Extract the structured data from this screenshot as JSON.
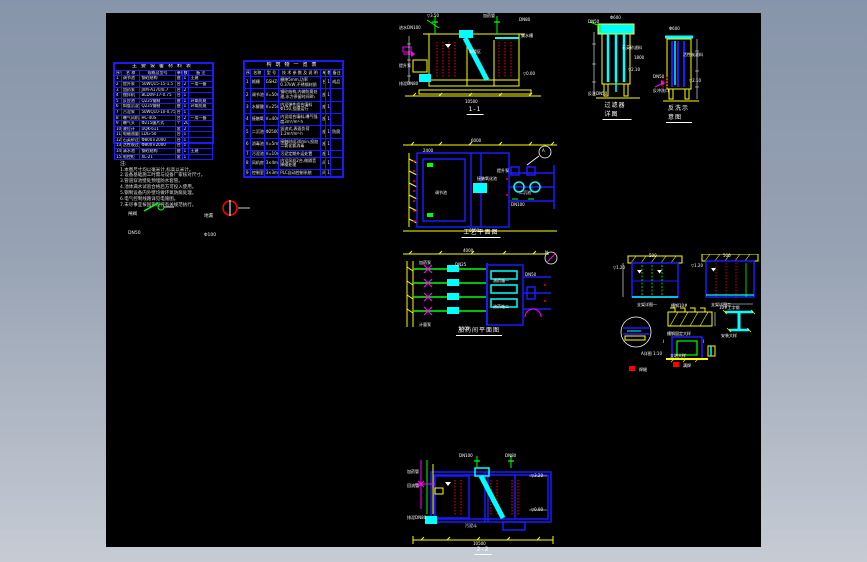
{
  "app": {
    "background_top": "#8795aa",
    "background_bottom": "#c6cbd4",
    "canvas_color": "#000000"
  },
  "colors": {
    "line_blue": "#1a1aff",
    "line_yellow": "#ffff00",
    "line_cyan": "#00ffff",
    "line_green": "#00ff00",
    "line_red": "#ff0000",
    "line_magenta": "#ff00ff",
    "text_white": "#ffffff"
  },
  "table1": {
    "title": "主要设备材料表",
    "headers": [
      "序号",
      "名 称",
      "规格及型号",
      "单位",
      "数量",
      "备 注"
    ],
    "rows": [
      [
        "1",
        "调节池",
        "钢砼结构",
        "座",
        "1",
        "土建"
      ],
      [
        "2",
        "提升泵",
        "50WQ15-15-1.5",
        "台",
        "2",
        "一用一备"
      ],
      [
        "3",
        "加药泵",
        "JXM-A170/0.7",
        "台",
        "2",
        ""
      ],
      [
        "4",
        "搅拌机",
        "BLD09-17-0.75",
        "台",
        "1",
        ""
      ],
      [
        "5",
        "反应池",
        "Q235钢制",
        "座",
        "1",
        "环氧防腐"
      ],
      [
        "6",
        "斜管沉淀池",
        "Q235钢制",
        "座",
        "1",
        "环氧防腐"
      ],
      [
        "7",
        "污泥泵",
        "50WQ10-10-0.75",
        "台",
        "1",
        ""
      ],
      [
        "8",
        "曝气风机",
        "HC-40S",
        "台",
        "2",
        "一用一备"
      ],
      [
        "9",
        "曝气头",
        "Φ215膜片式",
        "个",
        "20",
        ""
      ],
      [
        "10",
        "液位计",
        "UQK-611",
        "套",
        "2",
        ""
      ],
      [
        "11",
        "电磁流量计",
        "LDG-50",
        "台",
        "1",
        ""
      ],
      [
        "12",
        "石英砂过滤器",
        "Φ800×2000",
        "台",
        "1",
        ""
      ],
      [
        "13",
        "活性炭过滤器",
        "Φ800×2000",
        "台",
        "1",
        ""
      ],
      [
        "14",
        "清水池",
        "钢砼结构",
        "座",
        "1",
        "土建"
      ],
      [
        "15",
        "电控柜",
        "XL-21",
        "套",
        "1",
        ""
      ]
    ]
  },
  "table2": {
    "title": "构筑物一览表",
    "headers": [
      "序号",
      "名称",
      "型 号",
      "技 术 参 数 及 说 明",
      "单位",
      "数量",
      "备注"
    ],
    "rows": [
      [
        "1",
        "格栅",
        "GSHZ-500",
        "栅隙5mm,功率0.37kW,不锈钢材质",
        "台",
        "1",
        "成品"
      ],
      [
        "2",
        "调节池",
        "V=50m³",
        "钢砼结构,内做防腐处理,水力停留时间8h",
        "座",
        "1",
        ""
      ],
      [
        "3",
        "水解酸化池",
        "V=25m³",
        "内设弹性组合填料Φ150,挂膜运行",
        "座",
        "1",
        ""
      ],
      [
        "4",
        "接触氧化池",
        "V=40m³",
        "内设组合填料,曝气强度3m³/m²·h",
        "座",
        "1",
        ""
      ],
      [
        "5",
        "二沉池",
        "Φ2500",
        "竖流式,表面负荷1.2m³/m²·h",
        "座",
        "1",
        "防腐"
      ],
      [
        "6",
        "消毒池",
        "V=5m³",
        "接触时间30min,投加二氧化氯消毒",
        "座",
        "1",
        ""
      ],
      [
        "7",
        "污泥池",
        "V=10m³",
        "污泥定期外运处置",
        "座",
        "1",
        ""
      ],
      [
        "8",
        "风机房",
        "3×4m",
        "内设风机2台,做隔音降噪处理",
        "间",
        "1",
        ""
      ],
      [
        "9",
        "控制室",
        "3×3m",
        "PLC自动控制系统",
        "间",
        "1",
        ""
      ]
    ]
  },
  "notes": {
    "title": "注:",
    "lines": [
      "1.本图尺寸均以毫米计,标高以米计。",
      "2.设备基础施工时需与设备厂家核对尺寸。",
      "3.管道穿池壁处预埋防水套管。",
      "4.池体满水试验合格后方可投入使用。",
      "5.钢制设备内外壁均做环氧防腐处理。",
      "6.电气控制线路详见电施图。",
      "7.未尽事宜按国家现行有关规范执行。"
    ]
  },
  "legend": {
    "items": [
      {
        "top": "闸阀",
        "bottom": "DN50"
      },
      {
        "top": "地漏",
        "bottom": "Φ100"
      }
    ]
  },
  "drawings": {
    "section1": {
      "label": "1-1"
    },
    "filterA": {
      "label": "过滤器详图"
    },
    "filterB": {
      "label": "反洗示意图"
    },
    "plan1": {
      "label": "工艺平面图"
    },
    "plan2": {
      "label": "加药间平面图"
    },
    "section2": {
      "label": "2-2"
    }
  },
  "annotations": {
    "section1": [
      [
        "进水DN100",
        0,
        12
      ],
      [
        "▽3.50",
        28,
        0
      ],
      [
        "加药管",
        84,
        0
      ],
      [
        "DN80",
        120,
        4
      ],
      [
        "斜管区",
        70,
        36
      ],
      [
        "集水槽",
        122,
        20
      ],
      [
        "▽0.00",
        124,
        58
      ],
      [
        "提升泵",
        0,
        50
      ],
      [
        "排泥DN80",
        0,
        68
      ],
      [
        "10500",
        66,
        86
      ]
    ],
    "filterA": [
      [
        "DN50",
        0,
        4
      ],
      [
        "Φ600",
        22,
        0
      ],
      [
        "石英砂滤料",
        34,
        30
      ],
      [
        "▽2.10",
        40,
        52
      ],
      [
        "反洗DN50",
        0,
        76
      ],
      [
        "1800",
        46,
        40
      ]
    ],
    "filterB": [
      [
        "Φ600",
        16,
        0
      ],
      [
        "活性炭滤料",
        30,
        26
      ],
      [
        "DN50",
        0,
        48
      ],
      [
        "反冲洗口",
        0,
        62
      ],
      [
        "▽2.10",
        36,
        52
      ]
    ],
    "plan1": [
      [
        "6000",
        72,
        0
      ],
      [
        "2400",
        24,
        10
      ],
      [
        "调节池",
        36,
        52
      ],
      [
        "接触氧化池",
        78,
        38
      ],
      [
        "提升泵",
        98,
        30
      ],
      [
        "二沉池",
        120,
        52
      ],
      [
        "A",
        143,
        10
      ],
      [
        "DN100",
        112,
        64
      ],
      [
        "6000",
        70,
        90
      ]
    ],
    "plan2": [
      [
        "4000",
        64,
        0
      ],
      [
        "加药泵",
        20,
        12
      ],
      [
        "计量泵",
        20,
        74
      ],
      [
        "DN25",
        56,
        14
      ],
      [
        "溶药箱一",
        94,
        30
      ],
      [
        "溶药箱二",
        94,
        56
      ],
      [
        "DN50",
        126,
        24
      ],
      [
        "N",
        146,
        2
      ],
      [
        "2000",
        60,
        78
      ]
    ],
    "details": [
      [
        "500",
        38,
        0
      ],
      [
        "支架详图一",
        26,
        49
      ],
      [
        "500",
        112,
        0
      ],
      [
        "支架详图二",
        100,
        49
      ],
      [
        "槽钢10#",
        60,
        50
      ],
      [
        "槽钢固定大样",
        56,
        78
      ],
      [
        "A详图 1:10",
        30,
        98
      ],
      [
        "支墩大样",
        59,
        100
      ],
      [
        "10#工字钢",
        108,
        52
      ],
      [
        "安装大样",
        110,
        80
      ],
      [
        "Ⅰ",
        52,
        86
      ],
      [
        "Ⅰ",
        92,
        86
      ],
      [
        "▽1.20",
        2,
        12
      ],
      [
        "▽1.20",
        80,
        10
      ],
      [
        "焊缝",
        28,
        114
      ],
      [
        "满焊",
        72,
        110
      ]
    ],
    "section2": [
      [
        "DN100",
        52,
        0
      ],
      [
        "DN80",
        98,
        0
      ],
      [
        "加药管",
        0,
        16
      ],
      [
        "回流管",
        0,
        30
      ],
      [
        "▽3.20",
        124,
        20
      ],
      [
        "▽0.00",
        124,
        54
      ],
      [
        "污泥斗",
        58,
        70
      ],
      [
        "10500",
        66,
        88
      ],
      [
        "排泥DN80",
        0,
        62
      ]
    ]
  }
}
